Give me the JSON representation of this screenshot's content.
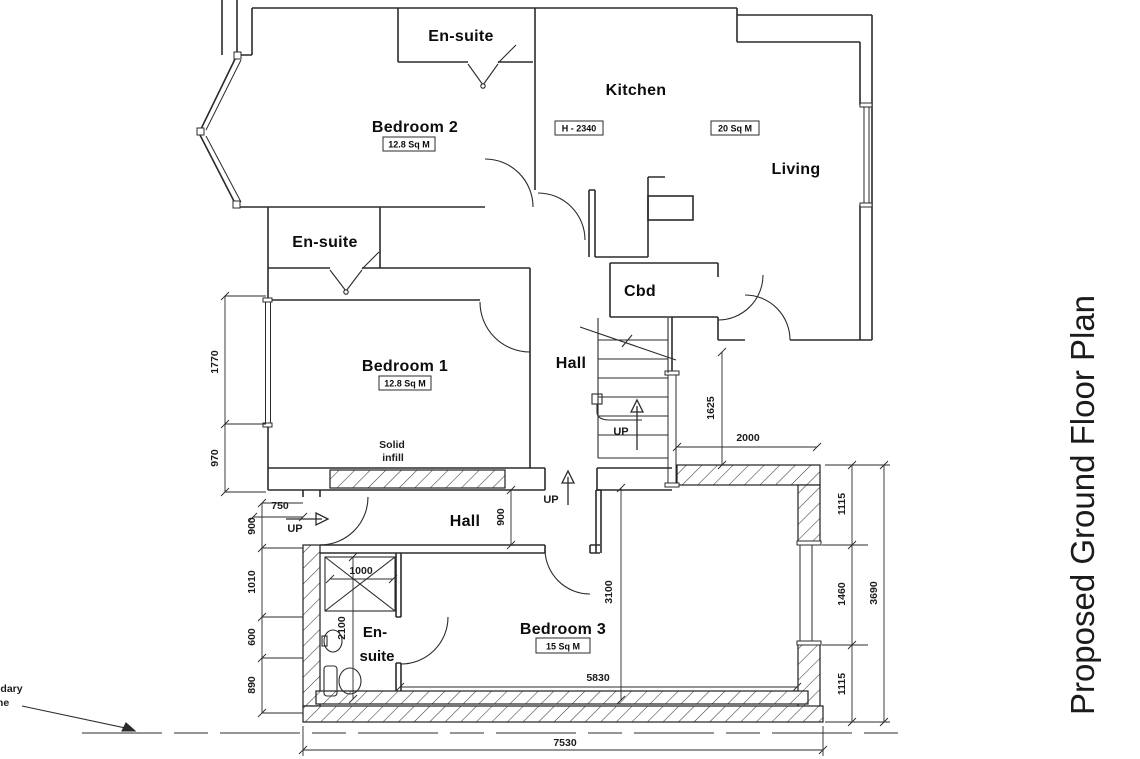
{
  "title": "Proposed Ground Floor Plan",
  "colors": {
    "line": "#2b2b2b",
    "background": "#ffffff",
    "text": "#0c0c0c"
  },
  "rooms": {
    "ensuite_top": {
      "label": "En-suite"
    },
    "bedroom2": {
      "label": "Bedroom 2",
      "area": "12.8 Sq M"
    },
    "kitchen": {
      "label": "Kitchen",
      "height_note": "H - 2340"
    },
    "living": {
      "label": "Living",
      "area": "20 Sq M"
    },
    "ensuite_mid": {
      "label": "En-suite"
    },
    "bedroom1": {
      "label": "Bedroom 1",
      "area": "12.8 Sq M"
    },
    "hall_upper": {
      "label": "Hall"
    },
    "cbd": {
      "label": "Cbd"
    },
    "hall_lower": {
      "label": "Hall"
    },
    "bedroom3": {
      "label": "Bedroom 3",
      "area": "15 Sq M"
    },
    "ensuite_lower": {
      "label_line1": "En-",
      "label_line2": "suite"
    }
  },
  "notes": {
    "solid_infill_line1": "Solid",
    "solid_infill_line2": "infill",
    "up_stairs": "UP",
    "up_hall": "UP",
    "up_entrance": "UP",
    "boundary_line1": "ndary",
    "boundary_line2": "ine"
  },
  "dimensions": {
    "d1770": "1770",
    "d970": "970",
    "d750": "750",
    "d900_left": "900",
    "d1010": "1010",
    "d600": "600",
    "d890": "890",
    "d900_hall": "900",
    "d1000": "1000",
    "d2100": "2100",
    "d1625": "1625",
    "d2000": "2000",
    "d3100": "3100",
    "d5830": "5830",
    "d7530": "7530",
    "d1115_top": "1115",
    "d1460": "1460",
    "d1115_bottom": "1115",
    "d3690": "3690"
  }
}
